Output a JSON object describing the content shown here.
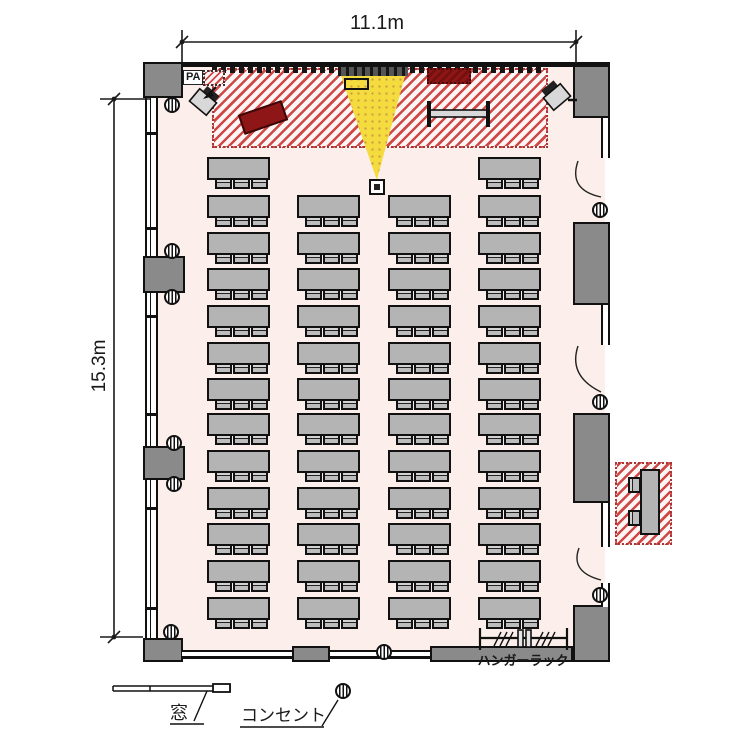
{
  "title": "seminar-room-floor-plan",
  "dimensions": {
    "width_label": "11.1m",
    "height_label": "15.3m"
  },
  "labels": {
    "pa": "PA",
    "window_legend": "窓",
    "outlet_legend": "コンセント",
    "hanger_rack": "ハンガーラック"
  },
  "colors": {
    "interior": "#fceeea",
    "wall_gray": "#8a8a8a",
    "table_gray": "#b4b4b4",
    "stage_hatch_red": "#cf4848",
    "projector_cone_yellow": "#f4dc3f",
    "lectern_maroon": "#8e1616",
    "line_black": "#111111"
  },
  "floor_plan": {
    "stage": {
      "hatched": true,
      "items": [
        "screen",
        "projector-cone",
        "lectern",
        "cabinet",
        "whiteboard",
        "speaker-left",
        "speaker-right",
        "pa-desk"
      ]
    },
    "seating": {
      "columns_x": [
        207,
        297,
        388,
        478
      ],
      "rows_y": [
        157,
        195,
        232,
        268,
        305,
        342,
        378,
        413,
        450,
        487,
        523,
        560,
        597
      ],
      "first_row_columns": [
        0,
        3
      ],
      "table_w": 63,
      "table_h": 23,
      "chairs_per_table": 3,
      "chair_offsets": [
        8,
        26,
        44
      ],
      "total_tables": 50,
      "total_chairs": 150
    },
    "outlets_xy": [
      [
        172,
        105
      ],
      [
        172,
        251
      ],
      [
        172,
        297
      ],
      [
        174,
        443
      ],
      [
        174,
        484
      ],
      [
        171,
        632
      ],
      [
        384,
        652
      ],
      [
        600,
        210
      ],
      [
        600,
        402
      ],
      [
        600,
        595
      ]
    ],
    "window_dividers_y": [
      132,
      227,
      315,
      413,
      507,
      607
    ],
    "doors_right_wall": 3,
    "reception_outside": {
      "tables": 1,
      "chairs": 2,
      "hatched": true
    },
    "hanger_rack_present": true
  }
}
